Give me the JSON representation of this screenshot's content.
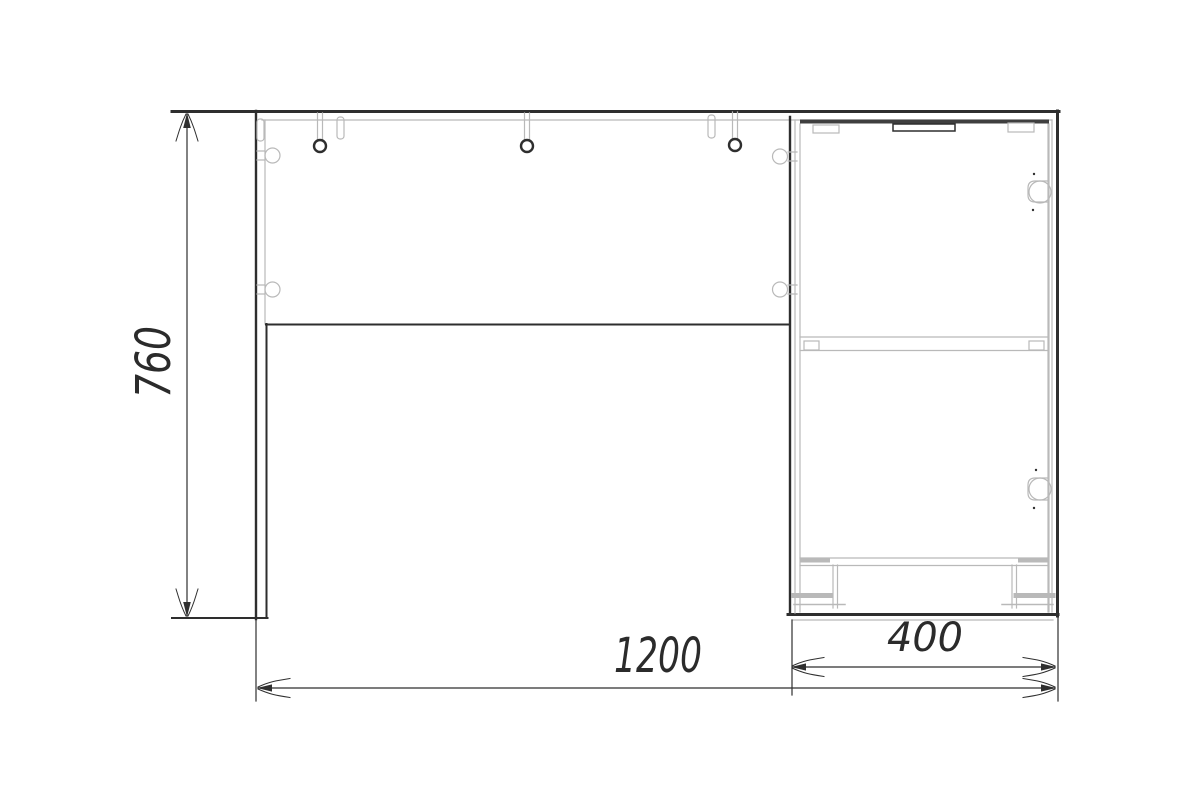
{
  "drawing": {
    "type": "furniture-assembly-technical-drawing",
    "subject": "desk with drawer unit - front elevation",
    "dimensions": {
      "height": {
        "value": "760",
        "orientation": "vertical",
        "side": "left"
      },
      "total_width": {
        "value": "1200",
        "orientation": "horizontal",
        "side": "bottom"
      },
      "drawer_unit_width": {
        "value": "400",
        "orientation": "horizontal",
        "side": "bottom-right"
      }
    },
    "colors": {
      "background": "#ffffff",
      "line_dark": "#2e2e2e",
      "line_band": "#3f3f3f",
      "line_light": "#b9b9b9",
      "dim_color": "#2f2f2f",
      "dim_text": "#2b2b2b"
    }
  }
}
